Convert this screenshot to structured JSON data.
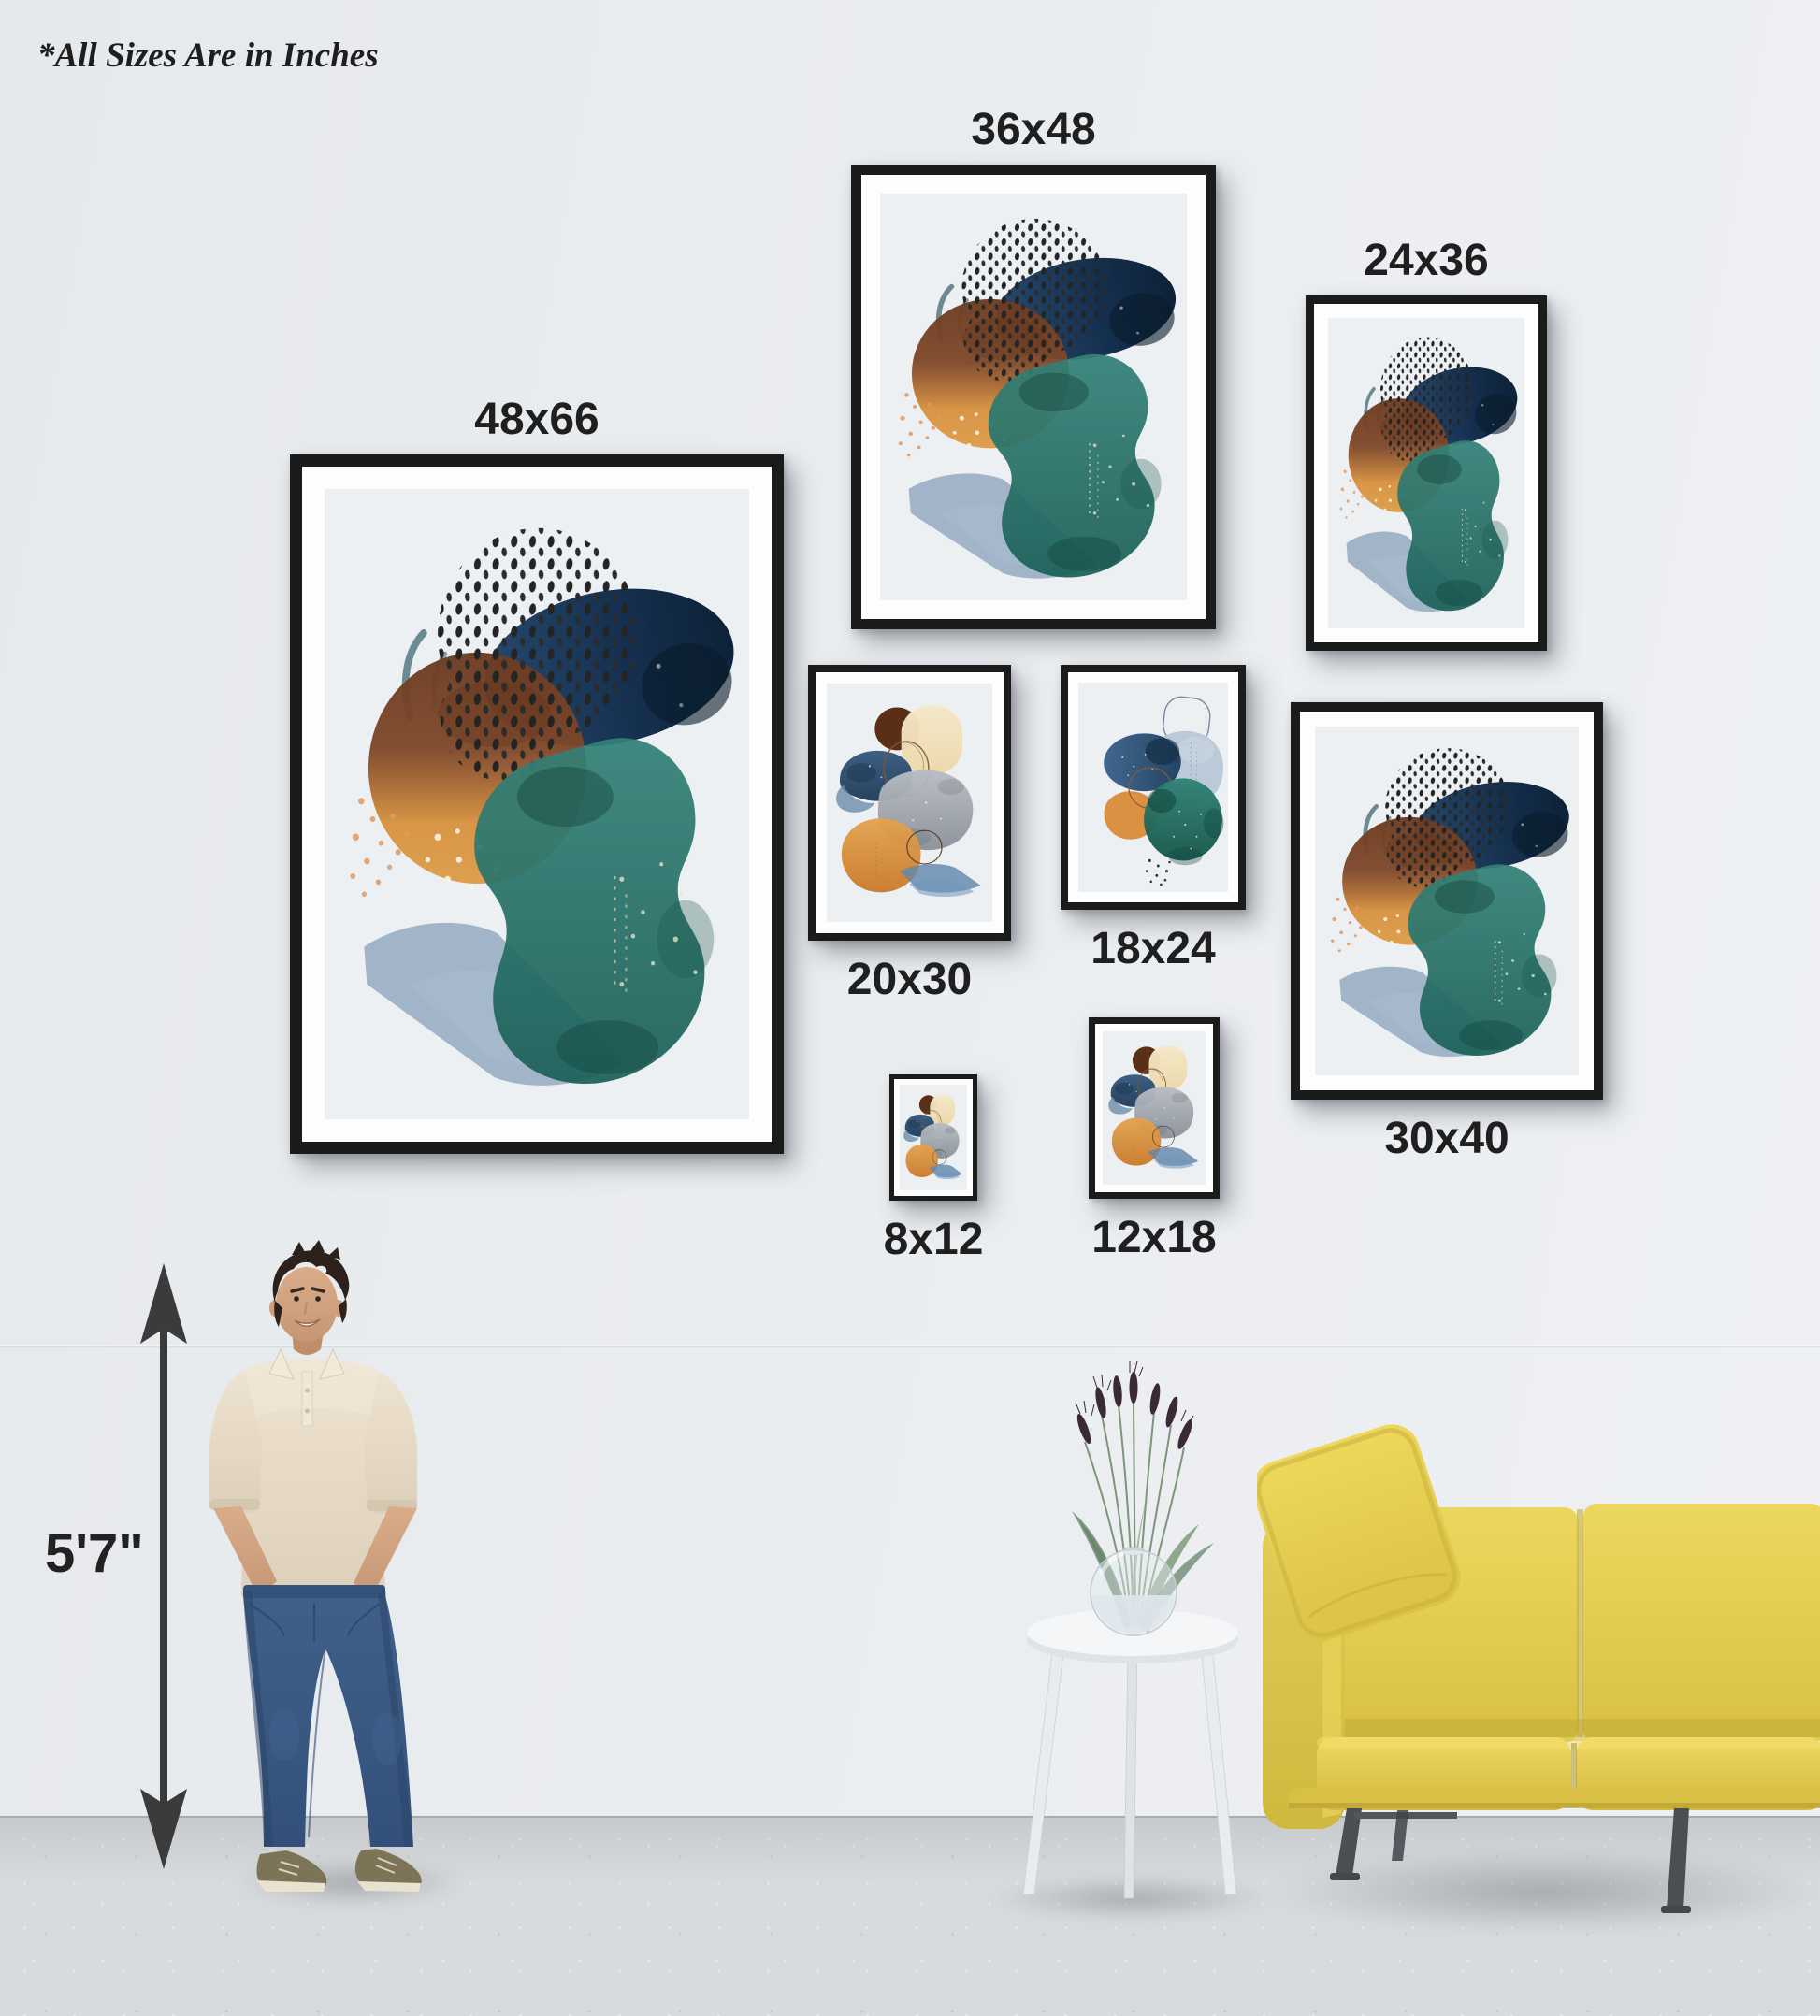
{
  "note": "*All Sizes Are in Inches",
  "height_reference": {
    "label": "5'7\""
  },
  "frames": [
    {
      "label": "48x66",
      "artwork": "abstract-watercolor-teal-brown-navy",
      "label_position": "above"
    },
    {
      "label": "36x48",
      "artwork": "abstract-watercolor-teal-brown-navy",
      "label_position": "above"
    },
    {
      "label": "24x36",
      "artwork": "abstract-watercolor-teal-brown-navy",
      "label_position": "above"
    },
    {
      "label": "20x30",
      "artwork": "abstract-watercolor-orange-gray-cream",
      "label_position": "below"
    },
    {
      "label": "18x24",
      "artwork": "abstract-watercolor-blue-teal-orange",
      "label_position": "below"
    },
    {
      "label": "30x40",
      "artwork": "abstract-watercolor-teal-brown-navy",
      "label_position": "below"
    },
    {
      "label": "8x12",
      "artwork": "abstract-watercolor-orange-gray-cream",
      "label_position": "below"
    },
    {
      "label": "12x18",
      "artwork": "abstract-watercolor-orange-gray-cream",
      "label_position": "below"
    }
  ],
  "scene": {
    "person": "man-standing-hands-in-pockets",
    "furniture": [
      "white-round-side-table",
      "glass-sphere-vase-with-dried-wheat",
      "yellow-three-seat-sofa"
    ]
  },
  "colors": {
    "wall": "#e9ecef",
    "floor": "#d8dbdd",
    "frame": "#1b1b1b",
    "label_text": "#1f1f1f",
    "sofa_yellow": "#e5cd4f",
    "art_navy": "#16304e",
    "art_teal": "#22695f",
    "art_brown": "#8a4f2a",
    "art_orange": "#d98a3f"
  }
}
